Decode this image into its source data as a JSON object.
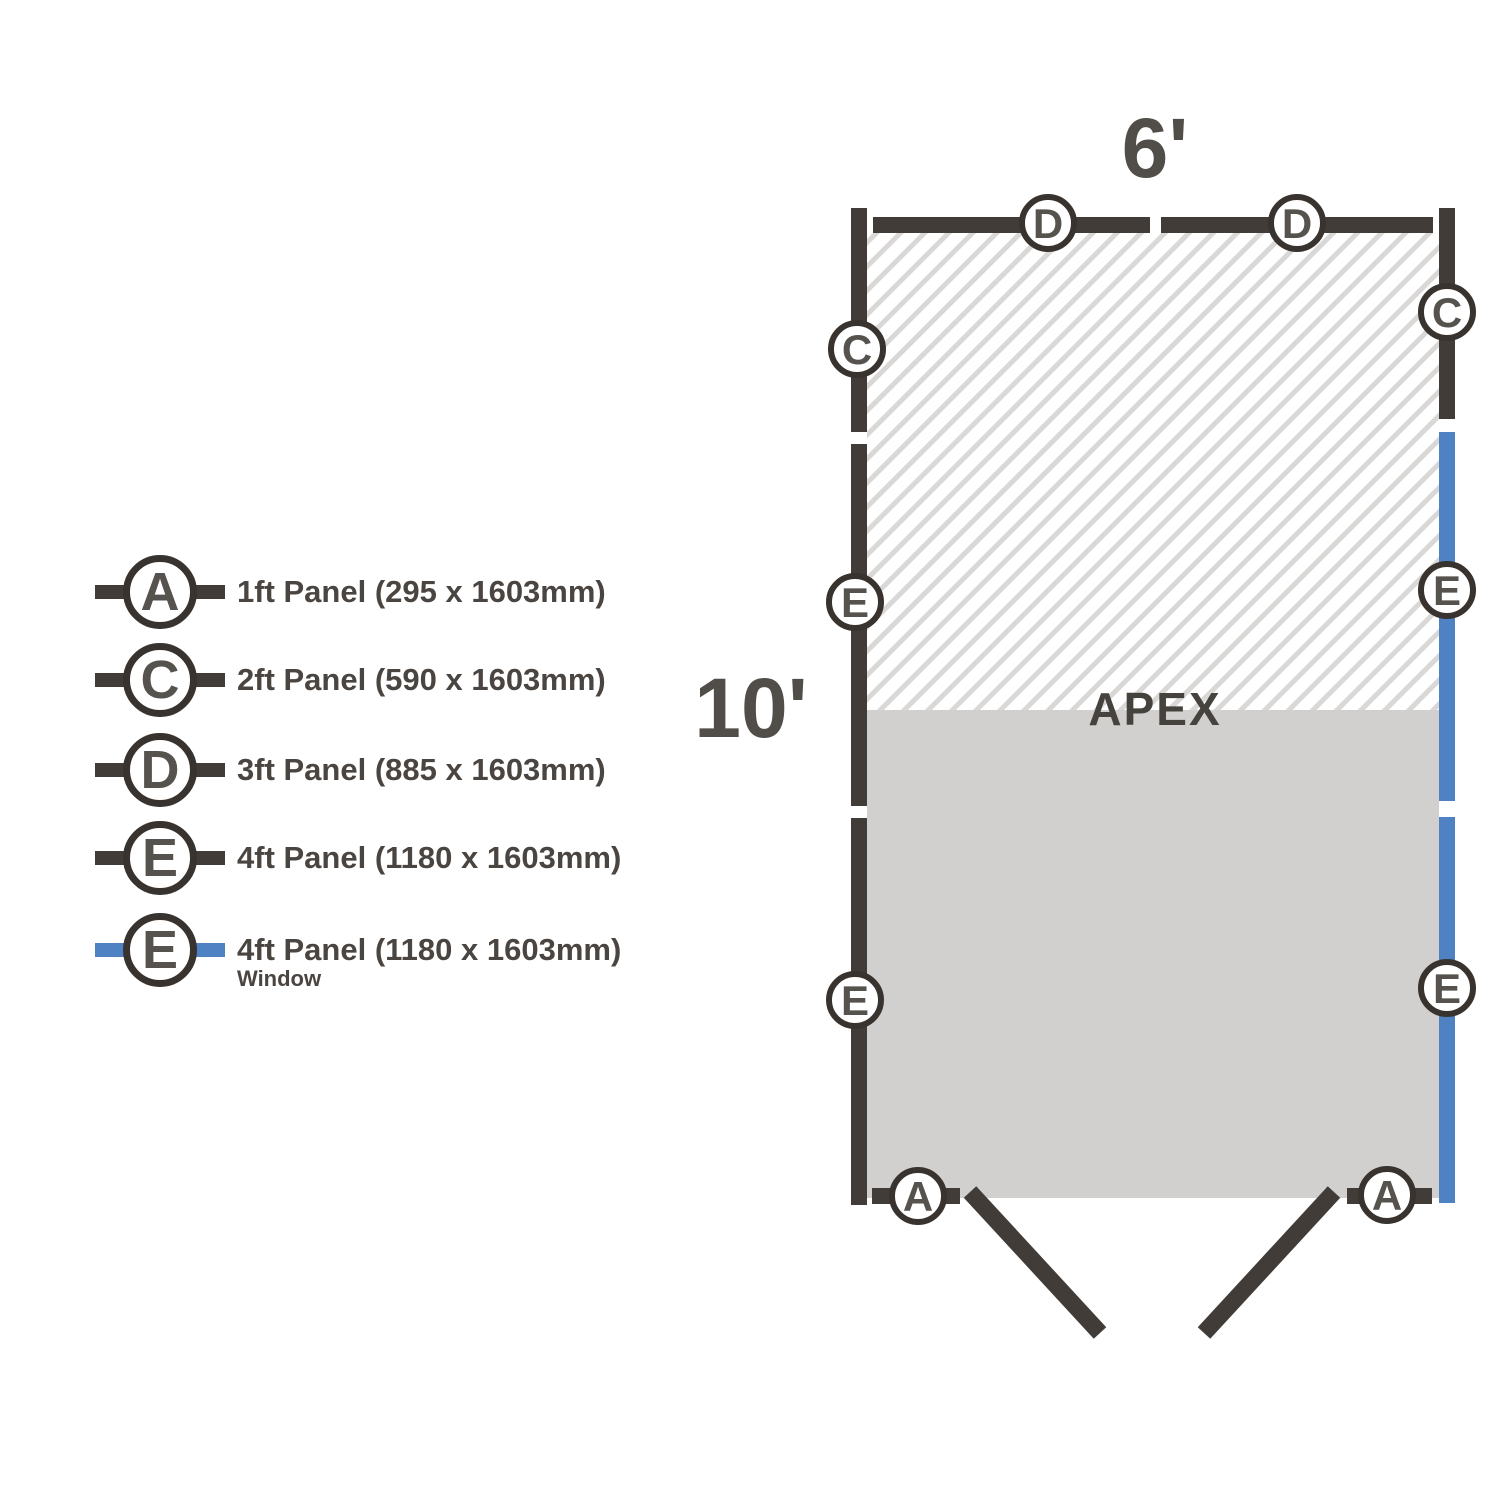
{
  "plan": {
    "width_label": "6'",
    "depth_label": "10'",
    "apex_label": "APEX",
    "markers": {
      "top_d1": "D",
      "top_d2": "D",
      "left_c": "C",
      "right_c": "C",
      "left_e1": "E",
      "right_e1": "E",
      "left_e2": "E",
      "right_e2": "E",
      "bottom_a1": "A",
      "bottom_a2": "A"
    }
  },
  "legend": {
    "items": [
      {
        "letter": "A",
        "label": "1ft Panel (295 x 1603mm)",
        "sublabel": "",
        "window": false
      },
      {
        "letter": "C",
        "label": "2ft Panel (590 x 1603mm)",
        "sublabel": "",
        "window": false
      },
      {
        "letter": "D",
        "label": "3ft Panel (885 x 1603mm)",
        "sublabel": "",
        "window": false
      },
      {
        "letter": "E",
        "label": "4ft Panel (1180 x 1603mm)",
        "sublabel": "",
        "window": false
      },
      {
        "letter": "E",
        "label": "4ft Panel (1180 x 1603mm)",
        "sublabel": "Window",
        "window": true
      }
    ]
  },
  "colors": {
    "wall_dark": "#423c38",
    "window_blue": "#4e82c3",
    "floor_gray": "#d2d0ce",
    "hatch_gray": "#d9d8d6",
    "text_gray": "#4a4541"
  }
}
